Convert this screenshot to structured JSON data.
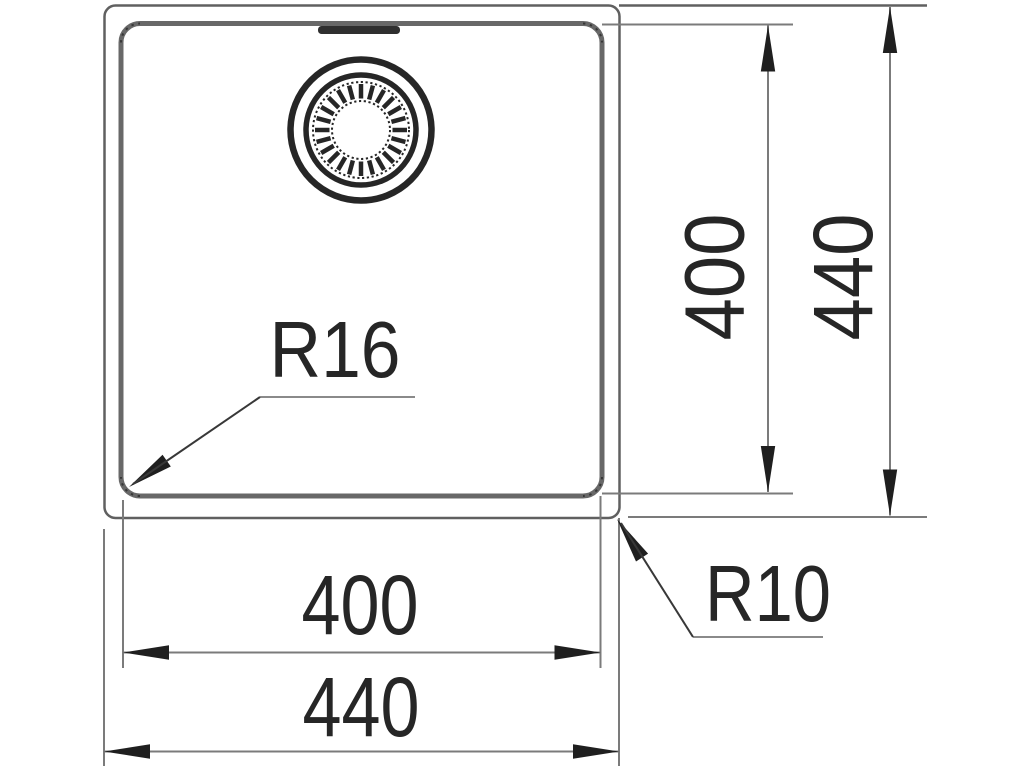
{
  "drawing": {
    "type": "technical dimension drawing",
    "subject": "square sink bowl with strainer drain, top view",
    "units": "mm"
  },
  "dimensions": {
    "inner_width": {
      "label": "400",
      "value_mm": 400,
      "orientation": "horizontal",
      "measures": "inner bowl width"
    },
    "outer_width": {
      "label": "440",
      "value_mm": 440,
      "orientation": "horizontal",
      "measures": "outer rim width"
    },
    "inner_depth": {
      "label": "400",
      "value_mm": 400,
      "orientation": "vertical",
      "measures": "inner bowl depth"
    },
    "outer_depth": {
      "label": "440",
      "value_mm": 440,
      "orientation": "vertical",
      "measures": "outer rim depth"
    },
    "inner_corner_radius": {
      "label": "R16",
      "value_mm": 16,
      "measures": "inner bowl corner radius"
    },
    "outer_corner_radius": {
      "label": "R10",
      "value_mm": 10,
      "measures": "outer rim corner radius"
    }
  },
  "features": {
    "drain": "circular strainer drain at top center",
    "overflow": "overflow slot at top inner edge"
  },
  "colors": {
    "background": "#ffffff",
    "outline_gray": "#606060",
    "inner_outline_gray": "#686868",
    "dimension_gray": "#7b7b7b",
    "ink": "#1f1f1f"
  }
}
